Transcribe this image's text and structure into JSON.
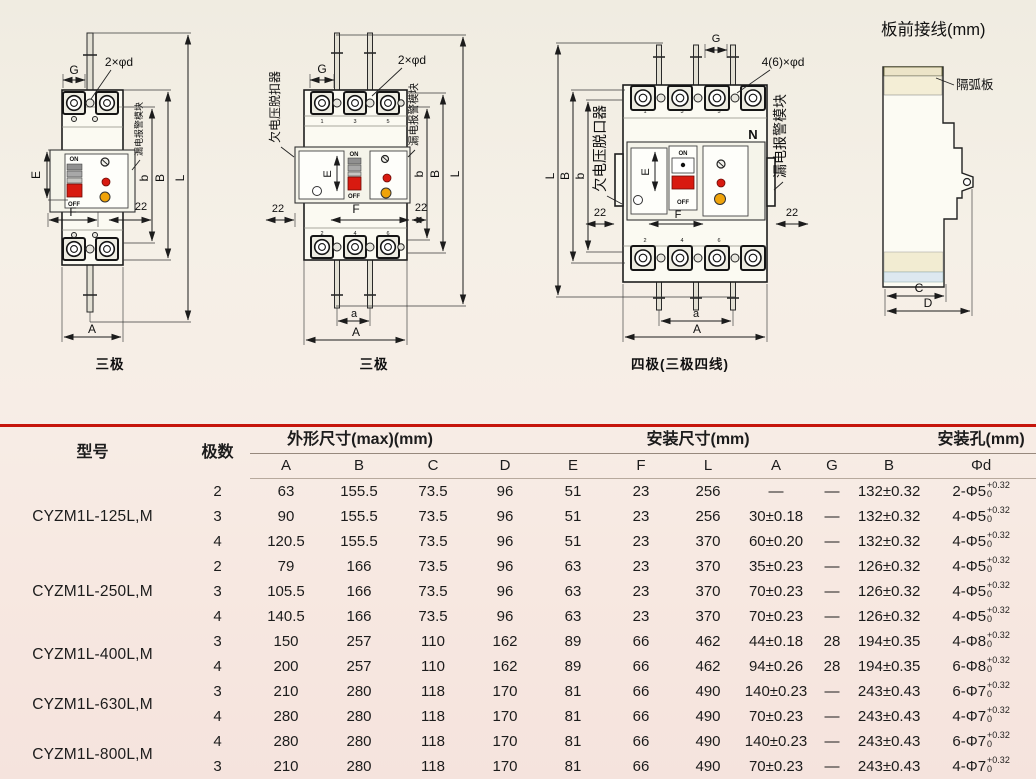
{
  "page": {
    "rule_color": "#c6150c"
  },
  "figures": {
    "pole2": {
      "caption": "三极",
      "dim_G": "G",
      "holes_label": "2×φd",
      "module_label": "漏电报警模块",
      "dim_E": "E",
      "dim_F": "F",
      "dim_22": "22",
      "dim_b": "b",
      "dim_B": "B",
      "dim_L": "L",
      "dim_A": "A",
      "on": "ON",
      "off": "OFF"
    },
    "pole3": {
      "caption": "三极",
      "release_label": "欠电压脱扣器",
      "dim_G": "G",
      "holes_label": "2×φd",
      "module_label": "漏电报警模块",
      "dim_E": "E",
      "dim_F": "F",
      "dim_22_left": "22",
      "dim_22_right": "22",
      "dim_b": "b",
      "dim_B": "B",
      "dim_L": "L",
      "dim_a": "a",
      "dim_A": "A",
      "on": "ON",
      "off": "OFF",
      "top_numbers": [
        "1",
        "3",
        "5"
      ],
      "bottom_numbers": [
        "2",
        "4",
        "6"
      ]
    },
    "pole4": {
      "caption": "四极(三极四线)",
      "release_label": "欠电压脱口器",
      "dim_G": "G",
      "holes_label": "4(6)×φd",
      "module_label": "漏电报警模块",
      "n_label": "N",
      "dim_E": "E",
      "dim_F": "F",
      "dim_22_left": "22",
      "dim_22_right": "22",
      "dim_b": "b",
      "dim_B": "B",
      "dim_L": "L",
      "dim_a": "a",
      "dim_A": "A",
      "on": "ON",
      "off": "OFF",
      "top_numbers": [
        "1",
        "3",
        "5"
      ],
      "bottom_numbers": [
        "2",
        "4",
        "6"
      ]
    },
    "side": {
      "title": "板前接线(mm)",
      "arc_plate_label": "隔弧板",
      "dim_C": "C",
      "dim_D": "D"
    }
  },
  "table": {
    "header": {
      "model": "型号",
      "poles": "极数",
      "outline": "外形尺寸(max)(mm)",
      "mounting": "安装尺寸(mm)",
      "holes": "安装孔(mm)"
    },
    "columns": [
      "A",
      "B",
      "C",
      "D",
      "E",
      "F",
      "L",
      "A",
      "G",
      "B",
      "Φd"
    ],
    "groups": [
      {
        "model": "CYZM1L-125L,M",
        "rows": [
          {
            "poles": "2",
            "A": "63",
            "B": "155.5",
            "C": "73.5",
            "D": "96",
            "E": "51",
            "F": "23",
            "L": "256",
            "MA": "—",
            "G": "—",
            "MB": "132±0.32",
            "hole": "2-Φ5",
            "tol_top": "+0.32",
            "tol_bot": "0"
          },
          {
            "poles": "3",
            "A": "90",
            "B": "155.5",
            "C": "73.5",
            "D": "96",
            "E": "51",
            "F": "23",
            "L": "256",
            "MA": "30±0.18",
            "G": "—",
            "MB": "132±0.32",
            "hole": "4-Φ5",
            "tol_top": "+0.32",
            "tol_bot": "0"
          },
          {
            "poles": "4",
            "A": "120.5",
            "B": "155.5",
            "C": "73.5",
            "D": "96",
            "E": "51",
            "F": "23",
            "L": "370",
            "MA": "60±0.20",
            "G": "—",
            "MB": "132±0.32",
            "hole": "4-Φ5",
            "tol_top": "+0.32",
            "tol_bot": "0"
          }
        ]
      },
      {
        "model": "CYZM1L-250L,M",
        "rows": [
          {
            "poles": "2",
            "A": "79",
            "B": "166",
            "C": "73.5",
            "D": "96",
            "E": "63",
            "F": "23",
            "L": "370",
            "MA": "35±0.23",
            "G": "—",
            "MB": "126±0.32",
            "hole": "4-Φ5",
            "tol_top": "+0.32",
            "tol_bot": "0"
          },
          {
            "poles": "3",
            "A": "105.5",
            "B": "166",
            "C": "73.5",
            "D": "96",
            "E": "63",
            "F": "23",
            "L": "370",
            "MA": "70±0.23",
            "G": "—",
            "MB": "126±0.32",
            "hole": "4-Φ5",
            "tol_top": "+0.32",
            "tol_bot": "0"
          },
          {
            "poles": "4",
            "A": "140.5",
            "B": "166",
            "C": "73.5",
            "D": "96",
            "E": "63",
            "F": "23",
            "L": "370",
            "MA": "70±0.23",
            "G": "—",
            "MB": "126±0.32",
            "hole": "4-Φ5",
            "tol_top": "+0.32",
            "tol_bot": "0"
          }
        ]
      },
      {
        "model": "CYZM1L-400L,M",
        "rows": [
          {
            "poles": "3",
            "A": "150",
            "B": "257",
            "C": "110",
            "D": "162",
            "E": "89",
            "F": "66",
            "L": "462",
            "MA": "44±0.18",
            "G": "28",
            "MB": "194±0.35",
            "hole": "4-Φ8",
            "tol_top": "+0.32",
            "tol_bot": "0"
          },
          {
            "poles": "4",
            "A": "200",
            "B": "257",
            "C": "110",
            "D": "162",
            "E": "89",
            "F": "66",
            "L": "462",
            "MA": "94±0.26",
            "G": "28",
            "MB": "194±0.35",
            "hole": "6-Φ8",
            "tol_top": "+0.32",
            "tol_bot": "0"
          }
        ]
      },
      {
        "model": "CYZM1L-630L,M",
        "rows": [
          {
            "poles": "3",
            "A": "210",
            "B": "280",
            "C": "118",
            "D": "170",
            "E": "81",
            "F": "66",
            "L": "490",
            "MA": "140±0.23",
            "G": "—",
            "MB": "243±0.43",
            "hole": "6-Φ7",
            "tol_top": "+0.32",
            "tol_bot": "0"
          },
          {
            "poles": "4",
            "A": "280",
            "B": "280",
            "C": "118",
            "D": "170",
            "E": "81",
            "F": "66",
            "L": "490",
            "MA": "70±0.23",
            "G": "—",
            "MB": "243±0.43",
            "hole": "4-Φ7",
            "tol_top": "+0.32",
            "tol_bot": "0"
          }
        ]
      },
      {
        "model": "CYZM1L-800L,M",
        "rows": [
          {
            "poles": "4",
            "A": "280",
            "B": "280",
            "C": "118",
            "D": "170",
            "E": "81",
            "F": "66",
            "L": "490",
            "MA": "140±0.23",
            "G": "—",
            "MB": "243±0.43",
            "hole": "6-Φ7",
            "tol_top": "+0.32",
            "tol_bot": "0"
          },
          {
            "poles": "3",
            "A": "210",
            "B": "280",
            "C": "118",
            "D": "170",
            "E": "81",
            "F": "66",
            "L": "490",
            "MA": "70±0.23",
            "G": "—",
            "MB": "243±0.43",
            "hole": "4-Φ7",
            "tol_top": "+0.32",
            "tol_bot": "0"
          }
        ]
      }
    ]
  }
}
